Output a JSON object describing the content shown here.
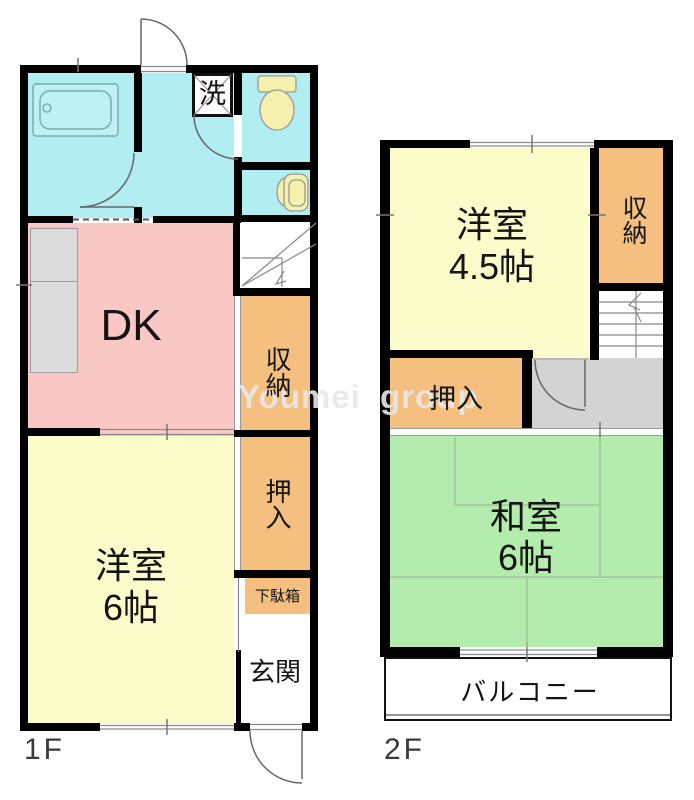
{
  "document": {
    "type": "apartment-floorplan"
  },
  "colors": {
    "room_cyan": "#b2eef1",
    "room_pink": "#f9c8c4",
    "room_yellow": "#fbfcc9",
    "closet_orange": "#f5bf80",
    "tatami_green": "#b4ecae",
    "hallway_gray": "#d3d3d3",
    "wall_black": "#000000",
    "fixture_yellow": "#f5f0ad"
  },
  "floor1": {
    "label": "1F",
    "dk": "DK",
    "laundry": "洗",
    "storage": "収納",
    "oshiire": "押入",
    "western_room_name": "洋室",
    "western_room_size": "6帖",
    "getabako": "下駄箱",
    "genkan": "玄関"
  },
  "floor2": {
    "label": "2F",
    "western_room_name": "洋室",
    "western_room_size": "4.5帖",
    "storage": "収納",
    "oshiire": "押入",
    "japanese_room_name": "和室",
    "japanese_room_size": "6帖",
    "balcony": "バルコニー"
  },
  "watermark": {
    "left": "Youmei",
    "right": "group"
  }
}
